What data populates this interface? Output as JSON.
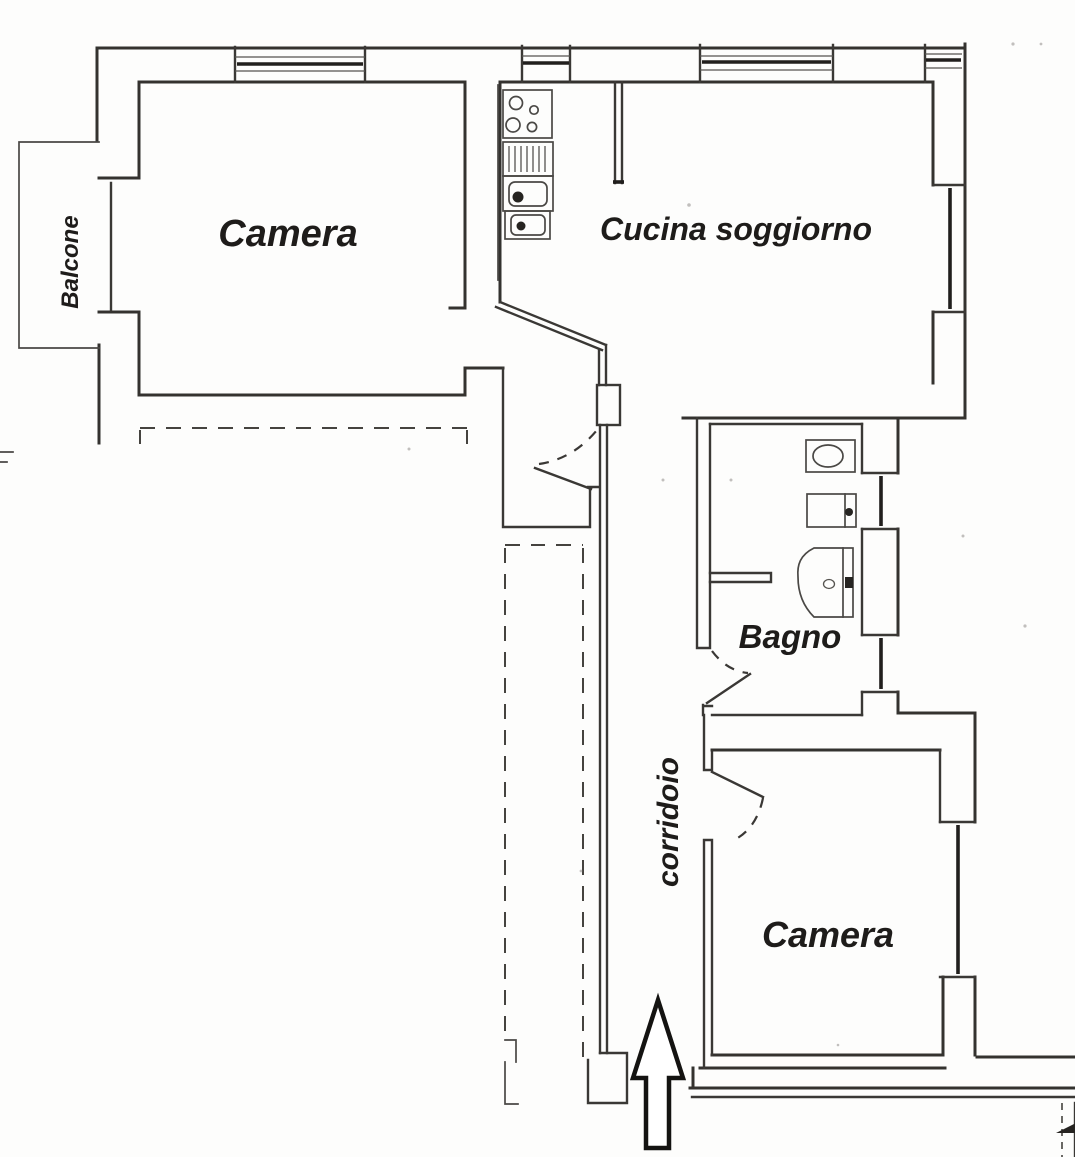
{
  "document": {
    "kind": "scanned apartment floor plan",
    "language": "Italian",
    "background_color": "#fdfdfc",
    "ink_color": "#34322f"
  },
  "rooms": [
    {
      "id": "camera-1",
      "label": "Camera"
    },
    {
      "id": "cucina-soggiorno",
      "label": "Cucina soggiorno"
    },
    {
      "id": "bagno",
      "label": "Bagno"
    },
    {
      "id": "camera-2",
      "label": "Camera"
    },
    {
      "id": "corridoio",
      "label": "corridoio"
    },
    {
      "id": "balcone",
      "label": "Balcone"
    }
  ],
  "fixtures": [
    {
      "name": "stove-with-four-burners"
    },
    {
      "name": "sink-drainer"
    },
    {
      "name": "kitchen-double-sink"
    },
    {
      "name": "bathroom-sink"
    },
    {
      "name": "bidet"
    },
    {
      "name": "toilet"
    }
  ],
  "entrance_arrow": {
    "direction": "up"
  }
}
